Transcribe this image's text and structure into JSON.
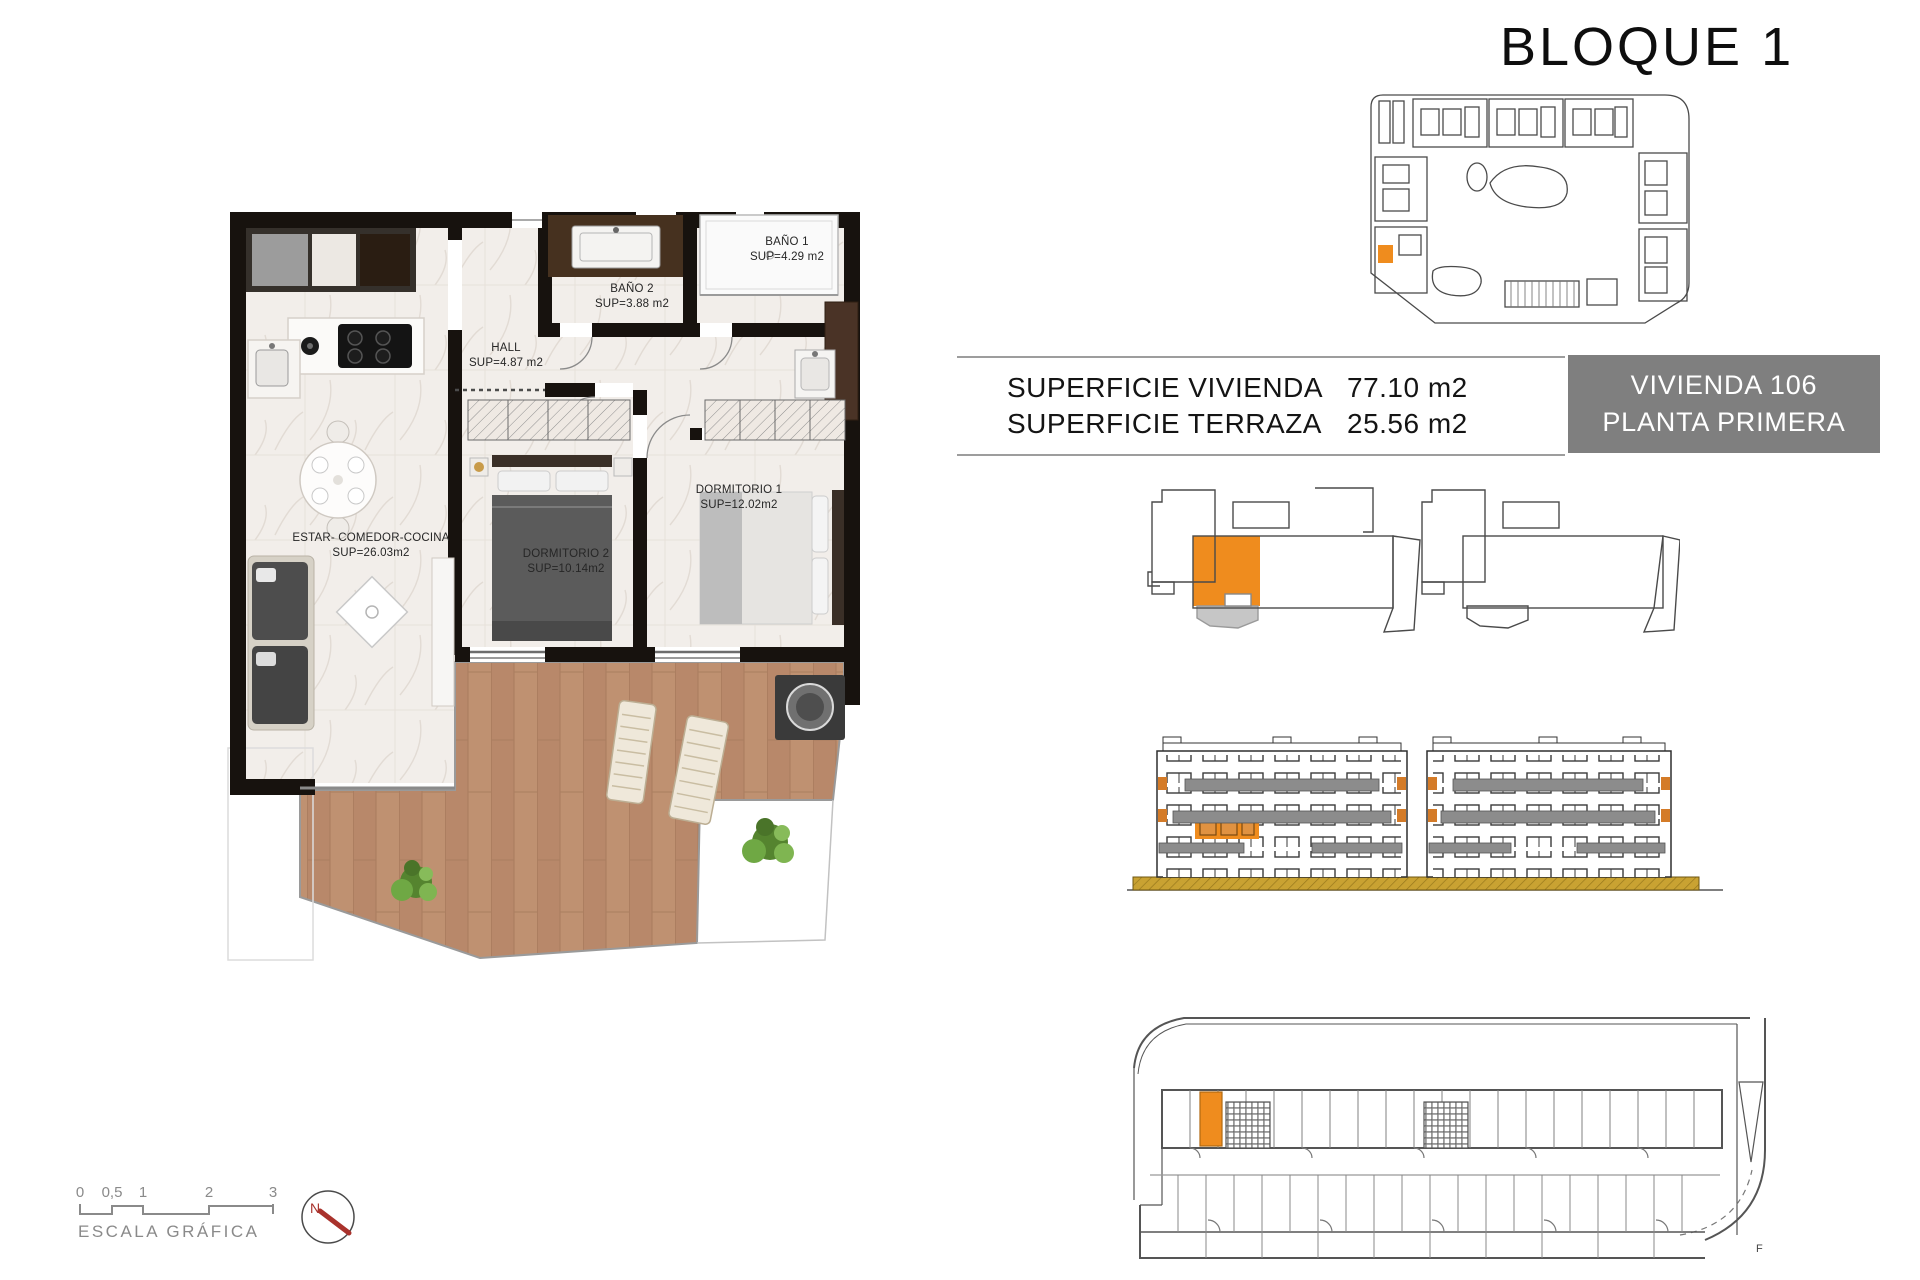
{
  "title": "BLOQUE 1",
  "info_table": {
    "rows": [
      {
        "label": "SUPERFICIE VIVIENDA",
        "value": "77.10 m2"
      },
      {
        "label": "SUPERFICIE TERRAZA",
        "value": "25.56 m2"
      }
    ]
  },
  "unit_box": {
    "line1": "VIVIENDA 106",
    "line2": "PLANTA PRIMERA"
  },
  "floor_plan": {
    "rooms": [
      {
        "name": "BAÑO 1",
        "area": "SUP=4.29 m2"
      },
      {
        "name": "BAÑO 2",
        "area": "SUP=3.88 m2"
      },
      {
        "name": "HALL",
        "area": "SUP=4.87 m2"
      },
      {
        "name": "DORMITORIO 1",
        "area": "SUP=12.02m2"
      },
      {
        "name": "DORMITORIO 2",
        "area": "SUP=10.14m2"
      },
      {
        "name": "ESTAR- COMEDOR-COCINA",
        "area": "SUP=26.03m2"
      }
    ]
  },
  "scale_bar": {
    "ticks": [
      "0",
      "0,5",
      "1",
      "2",
      "3"
    ],
    "label": "ESCALA GRÁFICA"
  },
  "compass": {
    "north_label": "N"
  },
  "garage_plan": {
    "corner_mark": "F"
  },
  "colors": {
    "highlight_orange": "#EF8C1E",
    "unit_box_bg": "#7F7F7F",
    "terrace_wood": "#BE9171",
    "terrace_gray": "#C6C6C6",
    "ground_khaki": "#C9A232",
    "wall_black": "#17120E",
    "compass_red": "#A9322C"
  }
}
